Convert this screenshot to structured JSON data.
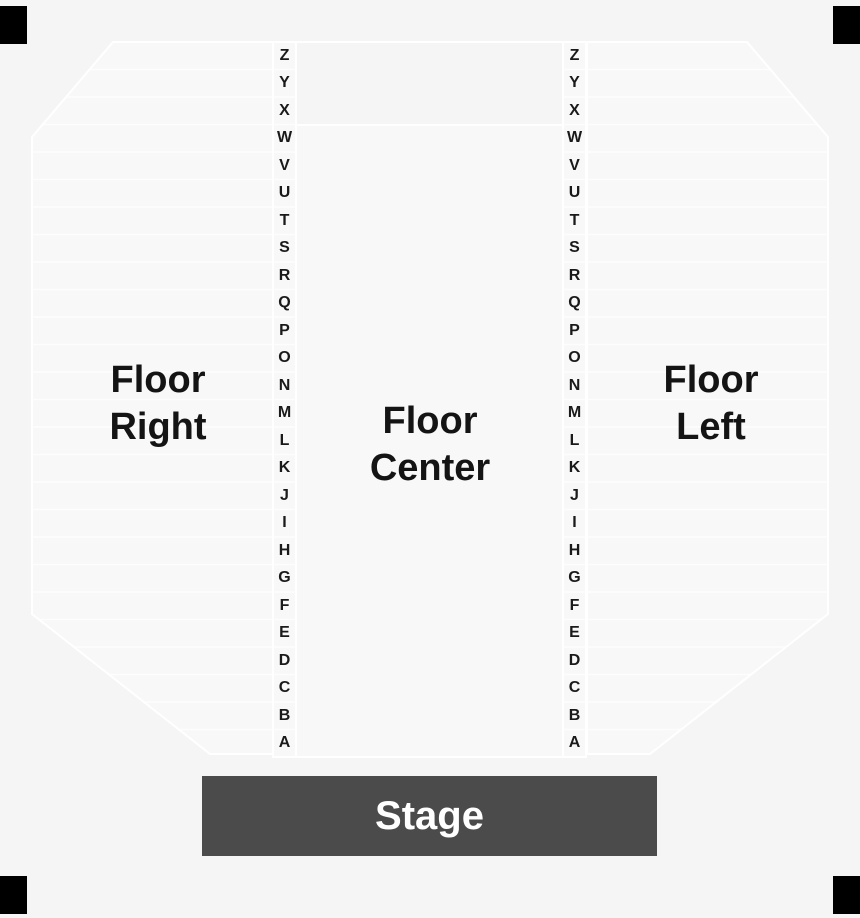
{
  "venue_map": {
    "sections": {
      "floor_right": {
        "label": "Floor Right",
        "line1": "Floor",
        "line2": "Right"
      },
      "floor_center": {
        "label": "Floor Center",
        "line1": "Floor",
        "line2": "Center"
      },
      "floor_left": {
        "label": "Floor Left",
        "line1": "Floor",
        "line2": "Left"
      }
    },
    "stage": {
      "label": "Stage"
    },
    "row_letters": [
      "Z",
      "Y",
      "X",
      "W",
      "V",
      "U",
      "T",
      "S",
      "R",
      "Q",
      "P",
      "O",
      "N",
      "M",
      "L",
      "K",
      "J",
      "I",
      "H",
      "G",
      "F",
      "E",
      "D",
      "C",
      "B",
      "A"
    ],
    "rows_count": 26,
    "colors": {
      "background": "#f5f5f5",
      "section_fill": "#f8f8f8",
      "outline": "#ffffff",
      "row_line": "rgba(255,255,255,0.7)",
      "stage_fill": "#4b4b4b",
      "stage_text": "#ffffff",
      "label_text": "#141414",
      "corner": "#000000"
    }
  }
}
